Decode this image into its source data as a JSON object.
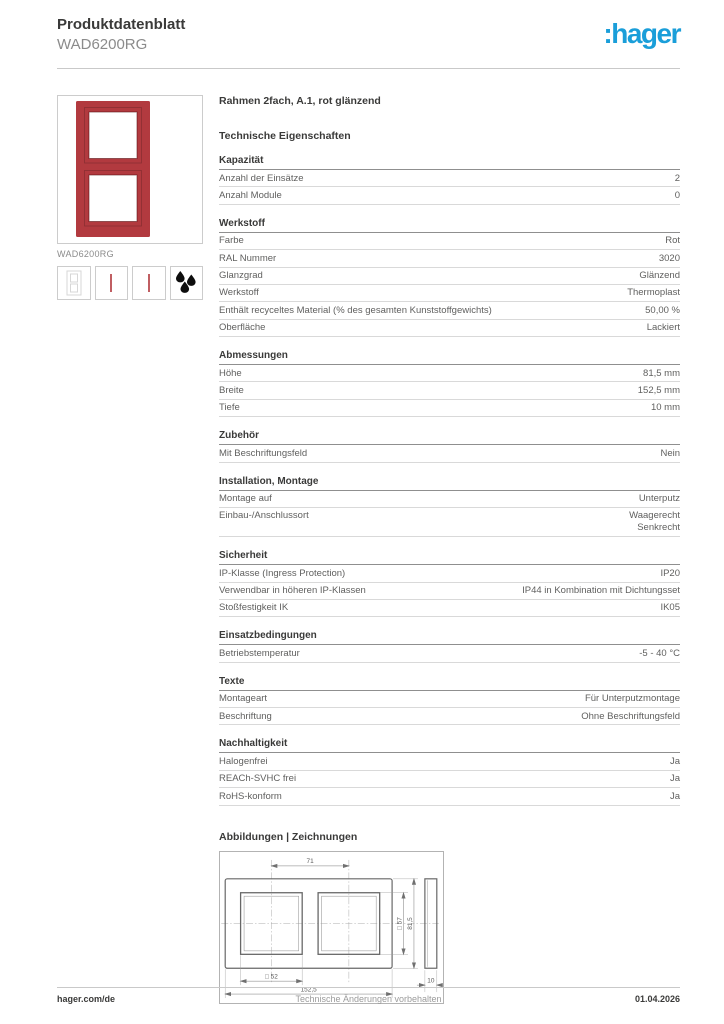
{
  "colors": {
    "brand_blue": "#1a9ed9",
    "product_red": "#b23a3f"
  },
  "header": {
    "title": "Produktdatenblatt",
    "reference": "WAD6200RG",
    "logo": ":hager"
  },
  "product": {
    "image_caption": "WAD6200RG",
    "thumbnails": [
      {
        "icon": "frame-outline-icon"
      },
      {
        "icon": "frame-profile-icon"
      },
      {
        "icon": "frame-profile-icon"
      },
      {
        "icon": "lacquer-drops-icon"
      }
    ]
  },
  "content": {
    "product_title": "Rahmen 2fach, A.1, rot glänzend",
    "tech_title": "Technische Eigenschaften",
    "sections": [
      {
        "title": "Kapazität",
        "rows": [
          {
            "label": "Anzahl der Einsätze",
            "value": "2"
          },
          {
            "label": "Anzahl Module",
            "value": "0"
          }
        ]
      },
      {
        "title": "Werkstoff",
        "rows": [
          {
            "label": "Farbe",
            "value": "Rot"
          },
          {
            "label": "RAL Nummer",
            "value": "3020"
          },
          {
            "label": "Glanzgrad",
            "value": "Glänzend"
          },
          {
            "label": "Werkstoff",
            "value": "Thermoplast"
          },
          {
            "label": "Enthält recyceltes Material (% des gesamten Kunststoffgewichts)",
            "value": "50,00 %"
          },
          {
            "label": "Oberfläche",
            "value": "Lackiert"
          }
        ]
      },
      {
        "title": "Abmessungen",
        "rows": [
          {
            "label": "Höhe",
            "value": "81,5 mm"
          },
          {
            "label": "Breite",
            "value": "152,5 mm"
          },
          {
            "label": "Tiefe",
            "value": "10 mm"
          }
        ]
      },
      {
        "title": "Zubehör",
        "rows": [
          {
            "label": "Mit Beschriftungsfeld",
            "value": "Nein"
          }
        ]
      },
      {
        "title": "Installation, Montage",
        "rows": [
          {
            "label": "Montage auf",
            "value": "Unterputz"
          },
          {
            "label": "Einbau-/Anschlussort",
            "value": [
              "Waagerecht",
              "Senkrecht"
            ]
          }
        ]
      },
      {
        "title": "Sicherheit",
        "rows": [
          {
            "label": "IP-Klasse (Ingress Protection)",
            "value": "IP20"
          },
          {
            "label": "Verwendbar in höheren IP-Klassen",
            "value": "IP44 in Kombination mit Dichtungsset"
          },
          {
            "label": "Stoßfestigkeit IK",
            "value": "IK05"
          }
        ]
      },
      {
        "title": "Einsatzbedingungen",
        "rows": [
          {
            "label": "Betriebstemperatur",
            "value": "-5 - 40 °C"
          }
        ]
      },
      {
        "title": "Texte",
        "rows": [
          {
            "label": "Montageart",
            "value": "Für Unterputzmontage"
          },
          {
            "label": "Beschriftung",
            "value": "Ohne Beschriftungsfeld"
          }
        ]
      },
      {
        "title": "Nachhaltigkeit",
        "rows": [
          {
            "label": "Halogenfrei",
            "value": "Ja"
          },
          {
            "label": "REACh-SVHC frei",
            "value": "Ja"
          },
          {
            "label": "RoHS-konform",
            "value": "Ja"
          }
        ]
      }
    ],
    "drawings_title": "Abbildungen | Zeichnungen",
    "drawing": {
      "dim_centers": "71",
      "dim_window": "□ 57",
      "dim_height": "81,5",
      "dim_opening": "□ 52",
      "dim_width": "152,5",
      "dim_depth": "10"
    }
  },
  "footer": {
    "left": "hager.com/de",
    "center": "Technische Änderungen vorbehalten",
    "right": "01.04.2026"
  }
}
